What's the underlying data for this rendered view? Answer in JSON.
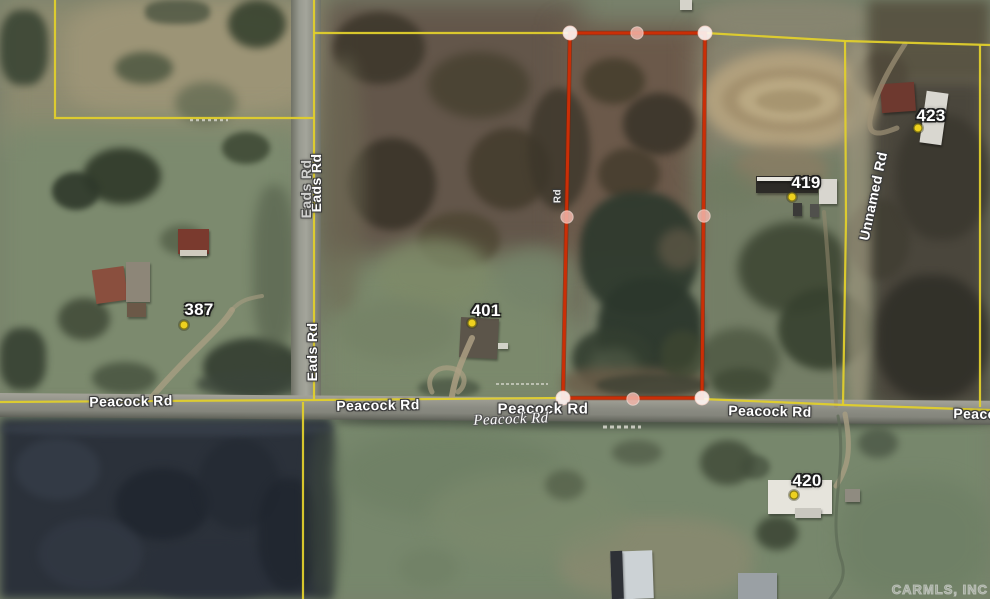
{
  "map_view": {
    "description": "Aerial satellite parcel map with subject property outlined",
    "watermark": "CARMLS, INC",
    "colors": {
      "parcel_outline_red": "#cb2e06",
      "boundary_yellow": "#e0cf2c",
      "address_dot_yellow": "#eed11f",
      "corner_marker": "#fdf4f1",
      "midpoint_marker": "#f2b6aa"
    },
    "roads": [
      {
        "name": "Eads Rd"
      },
      {
        "name": "Peacock Rd"
      },
      {
        "name": "Unnamed Rd"
      }
    ],
    "road_labels": [
      {
        "text": "Eads Rd",
        "x": 316,
        "y": 183,
        "rot": -90,
        "variant": "outline"
      },
      {
        "text": "Eads Rd",
        "x": 306,
        "y": 189,
        "rot": -90,
        "variant": "outline-dim"
      },
      {
        "text": "Eads Rd",
        "x": 312,
        "y": 352,
        "rot": -90,
        "variant": "outline"
      },
      {
        "text": "Rd",
        "x": 558,
        "y": 196,
        "rot": -90,
        "variant": "outline-small"
      },
      {
        "text": "Unnamed Rd",
        "x": 873,
        "y": 196,
        "rot": -78,
        "variant": "outline"
      },
      {
        "text": "Peacock Rd",
        "x": 131,
        "y": 401,
        "rot": -1,
        "variant": "outline"
      },
      {
        "text": "Peacock Rd",
        "x": 378,
        "y": 405,
        "rot": -1,
        "variant": "outline"
      },
      {
        "text": "Peacock Rd",
        "x": 543,
        "y": 409,
        "rot": 0,
        "variant": "outline-big"
      },
      {
        "text": "Peacock Rd",
        "x": 511,
        "y": 420,
        "rot": -2,
        "variant": "italic"
      },
      {
        "text": "Peacock Rd",
        "x": 770,
        "y": 411,
        "rot": 1,
        "variant": "outline"
      },
      {
        "text": "Peacock Rd",
        "x": 995,
        "y": 414,
        "rot": 1,
        "variant": "outline"
      }
    ],
    "address_points": [
      {
        "number": "387",
        "label_x": 199,
        "label_y": 310,
        "dot_x": 184,
        "dot_y": 325
      },
      {
        "number": "401",
        "label_x": 486,
        "label_y": 311,
        "dot_x": 472,
        "dot_y": 323
      },
      {
        "number": "419",
        "label_x": 806,
        "label_y": 183,
        "dot_x": 792,
        "dot_y": 197
      },
      {
        "number": "423",
        "label_x": 931,
        "label_y": 116,
        "dot_x": 918,
        "dot_y": 128
      },
      {
        "number": "420",
        "label_x": 807,
        "label_y": 481,
        "dot_x": 794,
        "dot_y": 495
      }
    ],
    "subject_parcel": {
      "vertices": [
        [
          570,
          33
        ],
        [
          705,
          33
        ],
        [
          702,
          398
        ],
        [
          563,
          398
        ]
      ],
      "corner_markers": [
        [
          570,
          33
        ],
        [
          705,
          33
        ],
        [
          702,
          398
        ],
        [
          563,
          398
        ]
      ],
      "midpoint_markers": [
        [
          637,
          33
        ],
        [
          704,
          216
        ],
        [
          633,
          399
        ],
        [
          567,
          217
        ]
      ]
    },
    "boundary_lines": [
      {
        "name": "northwest-parcel",
        "points": [
          [
            55,
            0
          ],
          [
            55,
            118
          ],
          [
            314,
            118
          ]
        ]
      },
      {
        "name": "eads-rd-east",
        "points": [
          [
            314,
            0
          ],
          [
            314,
            400
          ]
        ]
      },
      {
        "name": "north-boundary-west",
        "points": [
          [
            314,
            33
          ],
          [
            570,
            33
          ]
        ]
      },
      {
        "name": "north-boundary-east",
        "points": [
          [
            705,
            33
          ],
          [
            845,
            41
          ],
          [
            990,
            45
          ]
        ]
      },
      {
        "name": "unnamed-rd-west",
        "points": [
          [
            845,
            41
          ],
          [
            846,
            220
          ],
          [
            843,
            405
          ]
        ]
      },
      {
        "name": "east-boundary",
        "points": [
          [
            980,
            45
          ],
          [
            980,
            407
          ]
        ]
      },
      {
        "name": "peacock-rd-north-west",
        "points": [
          [
            0,
            402
          ],
          [
            315,
            400
          ],
          [
            560,
            398
          ]
        ]
      },
      {
        "name": "peacock-rd-north-east",
        "points": [
          [
            702,
            399
          ],
          [
            845,
            405
          ],
          [
            990,
            410
          ]
        ]
      },
      {
        "name": "south-of-peacock",
        "points": [
          [
            303,
            402
          ],
          [
            303,
            599
          ]
        ]
      }
    ]
  }
}
